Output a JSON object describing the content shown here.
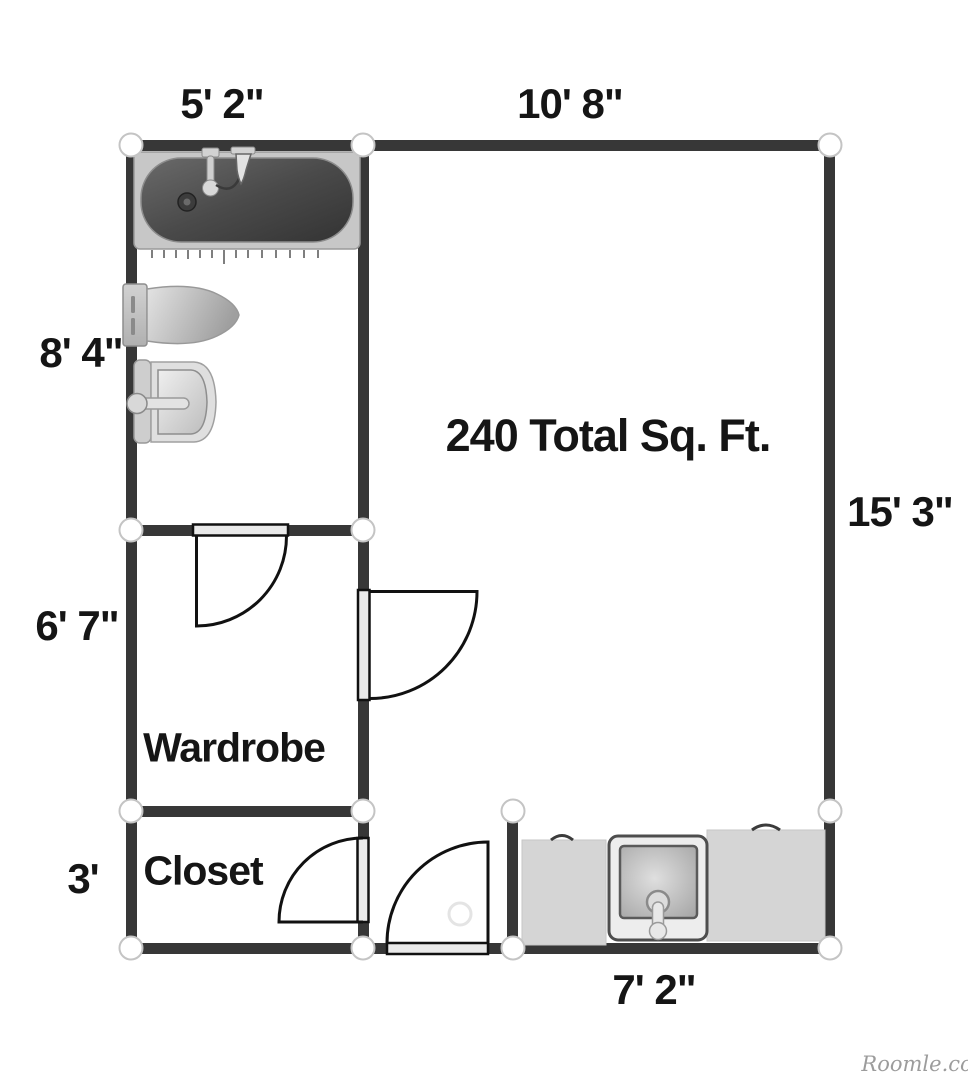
{
  "plan": {
    "area_label": "240 Total Sq. Ft.",
    "rooms": {
      "wardrobe": "Wardrobe",
      "closet": "Closet"
    },
    "dimensions": {
      "bathroom_width": "5' 2\"",
      "main_room_width": "10' 8\"",
      "bathroom_height": "8' 4\"",
      "main_room_height": "15' 3\"",
      "wardrobe_height": "6' 7\"",
      "closet_height": "3'",
      "kitchen_width": "7' 2\""
    },
    "colors": {
      "wall": "#373737",
      "counter": "#d5d5d5",
      "node_stroke": "#c4c4c4",
      "text": "#151515",
      "watermark": "#9c9c9c"
    }
  },
  "watermark": "Roomle.com"
}
